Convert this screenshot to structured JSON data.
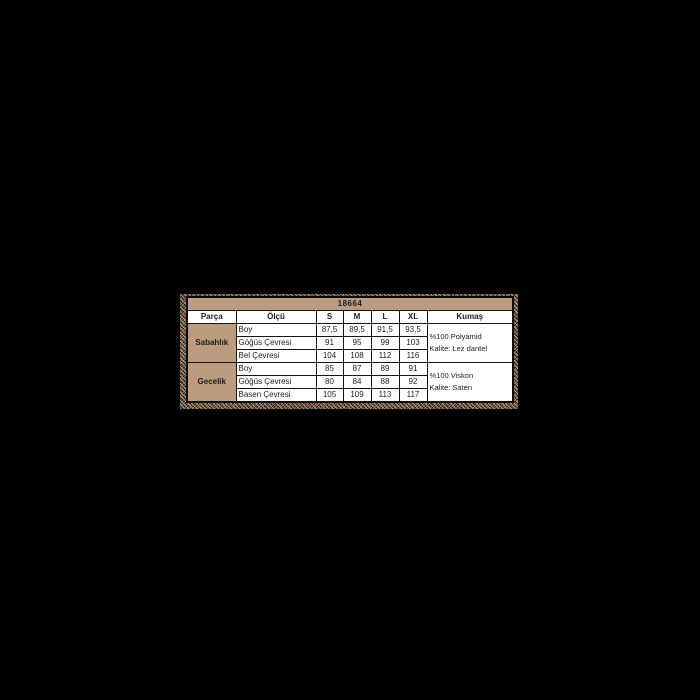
{
  "page": {
    "background_color": "#000000"
  },
  "table": {
    "title": "18664",
    "columns": [
      "Parça",
      "Ölçü",
      "S",
      "M",
      "L",
      "XL",
      "Kumaş"
    ],
    "groups": [
      {
        "name": "Sabahlık",
        "rows": [
          {
            "label": "Boy",
            "values": [
              "87,5",
              "89,5",
              "91,5",
              "93,5"
            ]
          },
          {
            "label": "Göğüs Çevresi",
            "values": [
              "91",
              "95",
              "99",
              "103"
            ]
          },
          {
            "label": "Bel Çevresi",
            "values": [
              "104",
              "108",
              "112",
              "116"
            ]
          }
        ],
        "fabric": [
          "%100 Polyamid",
          "Kalite: Lez dantel"
        ]
      },
      {
        "name": "Gecelik",
        "rows": [
          {
            "label": "Boy",
            "values": [
              "85",
              "87",
              "89",
              "91"
            ]
          },
          {
            "label": "Göğüs Çevresi",
            "values": [
              "80",
              "84",
              "88",
              "92"
            ]
          },
          {
            "label": "Basen Çevresi",
            "values": [
              "105",
              "109",
              "113",
              "117"
            ]
          }
        ],
        "fabric": [
          "%100 Viskon",
          "Kalite: Saten"
        ]
      }
    ],
    "colors": {
      "accent_tan": "#bb9c81",
      "border": "#151515",
      "cell_background": "#ffffff",
      "page_background": "#000000"
    }
  }
}
